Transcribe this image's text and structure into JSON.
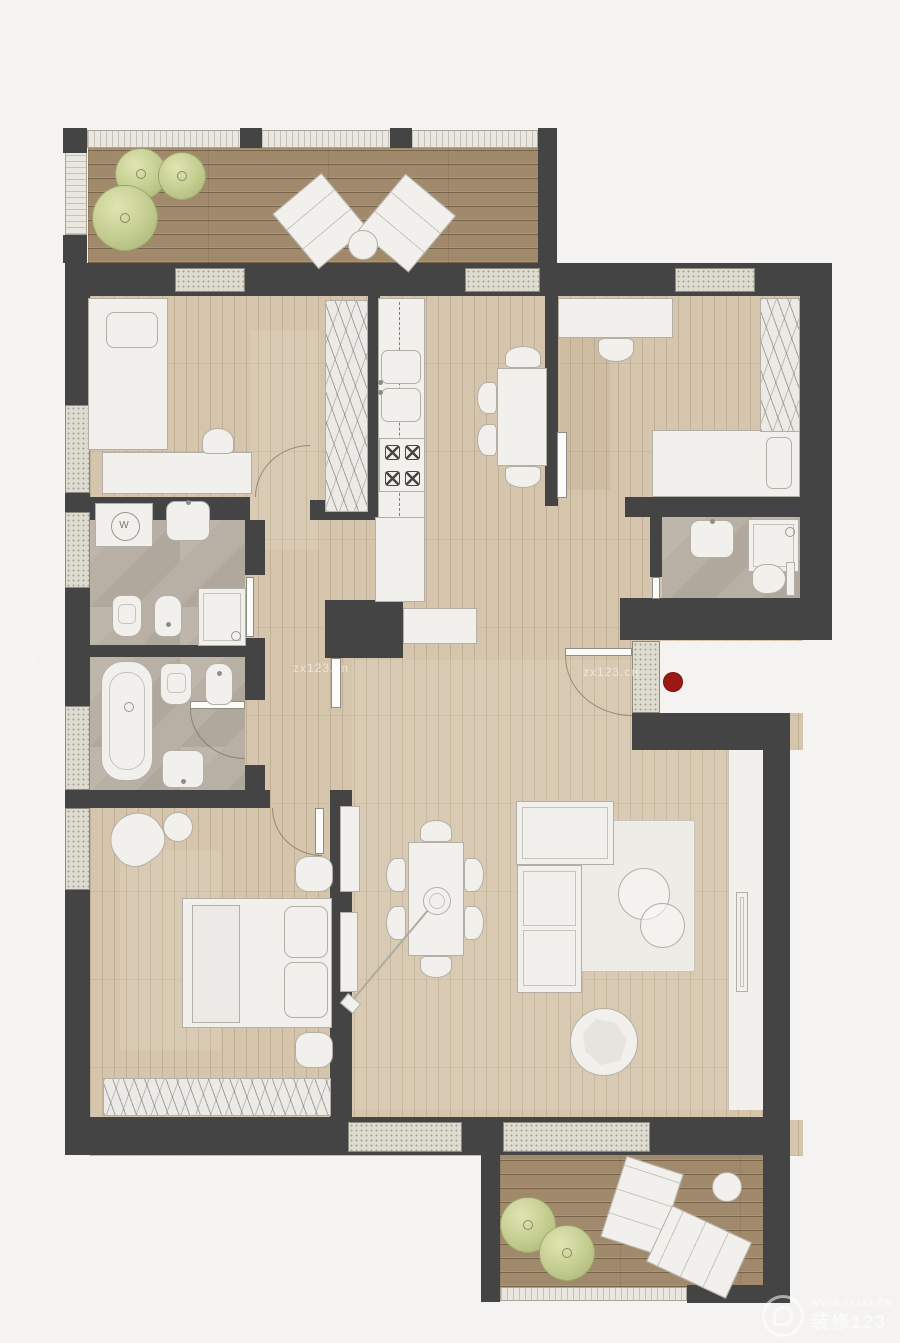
{
  "meta": {
    "type": "floor-plan",
    "view": "top-down apartment plan with furniture"
  },
  "palette": {
    "background": "#f4f3f1",
    "wall": "#444444",
    "wood_floor": "#d5c5ac",
    "deck": "#a1896b",
    "bath_floor": "#b9b0a5",
    "furniture_fill": "#f1f0ed",
    "furniture_line": "#b3afa7",
    "window_sill": "#dedbd0",
    "rail": "#e9e7df",
    "plant_green": "#c3cc8f",
    "red_marker": "#9c1a16"
  },
  "labels": {
    "washing_machine": "W"
  },
  "watermarks": {
    "mid_left": "zx123.cn",
    "mid_right": "zx123.cn",
    "edge_left": "zx123.cn",
    "corner_url": "WWW.ZX123.CN",
    "corner_brand": "装修123"
  },
  "markers": {
    "entry_dot_color": "#9c1a16"
  },
  "floorplan": {
    "rooms": [
      {
        "id": "terrace-top",
        "items": [
          "plant",
          "plant",
          "plant",
          "lounge-chair",
          "lounge-chair",
          "side-table"
        ]
      },
      {
        "id": "bedroom-top-left",
        "items": [
          "single-bed",
          "desk",
          "chair",
          "wardrobe"
        ]
      },
      {
        "id": "kitchen",
        "items": [
          "counter",
          "double-sink",
          "stove",
          "table",
          "chairs"
        ]
      },
      {
        "id": "bedroom-top-right",
        "items": [
          "desk",
          "chair",
          "single-bed",
          "wardrobe",
          "sliding-door"
        ]
      },
      {
        "id": "bathroom-ensuite",
        "items": [
          "sink",
          "shower",
          "toilet",
          "sliding-door"
        ]
      },
      {
        "id": "bathroom-upper",
        "items": [
          "washing-machine",
          "sink",
          "toilet",
          "bidet",
          "shower"
        ]
      },
      {
        "id": "bathroom-lower",
        "items": [
          "bathtub",
          "toilet",
          "bidet",
          "sink"
        ]
      },
      {
        "id": "bedroom-bottom-left",
        "items": [
          "armchair",
          "side-table",
          "double-bed",
          "pouf",
          "pouf",
          "wardrobe"
        ]
      },
      {
        "id": "living-dining",
        "items": [
          "sideboard",
          "dining-table",
          "chairs",
          "arc-lamp",
          "corner-sofa",
          "rug",
          "coffee-table",
          "coffee-table",
          "pouf-blanket",
          "tv-wall"
        ]
      },
      {
        "id": "terrace-bottom",
        "items": [
          "plant",
          "plant",
          "sun-lounger",
          "sun-lounger",
          "side-table"
        ]
      }
    ]
  }
}
